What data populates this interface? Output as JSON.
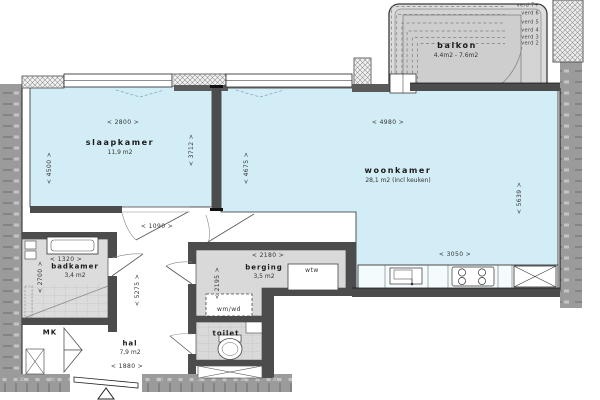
{
  "plan": {
    "colors": {
      "room_fill": "#d3edf6",
      "floor_gray": "#dcdcdc",
      "wall_dark": "#4c4c4c",
      "wall_outer": "#9b9b9b",
      "balcony_fill": "#d2d2d2"
    },
    "rooms": {
      "slaapkamer": {
        "name": "slaapkamer",
        "area": "11,9 m2"
      },
      "woonkamer": {
        "name": "woonkamer",
        "area": "28,1 m2 (incl keuken)"
      },
      "balkon": {
        "name": "balkon",
        "area": "4.4m2 - 7.6m2"
      },
      "badkamer": {
        "name": "badkamer",
        "area": "3,4 m2"
      },
      "berging": {
        "name": "berging",
        "area": "3,5 m2"
      },
      "toilet": {
        "name": "toilet"
      },
      "hal": {
        "name": "hal",
        "area": "7,9 m2"
      },
      "meterkast": {
        "name": "MK"
      }
    },
    "fixtures": {
      "wtw": "wtw",
      "wm_wd": "wm/wd"
    },
    "dims": {
      "w2800": "< 2800 >",
      "h4500": "< 4500 >",
      "h3712": "< 3712 >",
      "w1090": "< 1090 >",
      "h4675": "< 4675 >",
      "w4980": "< 4980 >",
      "h5639": "< 5639 >",
      "w3050": "< 3050 >",
      "w2180": "< 2180 >",
      "h2195": "< 2195 >",
      "w1320": "< 1320 >",
      "h2700": "< 2700 >",
      "h5275": "< 5275 >",
      "w1880": "< 1880 >"
    },
    "balkon_levels": {
      "v7": "verd 7+",
      "v6": "verd 6",
      "v5": "verd 5",
      "v4": "verd 4",
      "v3": "verd 3",
      "v2": "verd 2"
    },
    "wall_mark": "30"
  }
}
